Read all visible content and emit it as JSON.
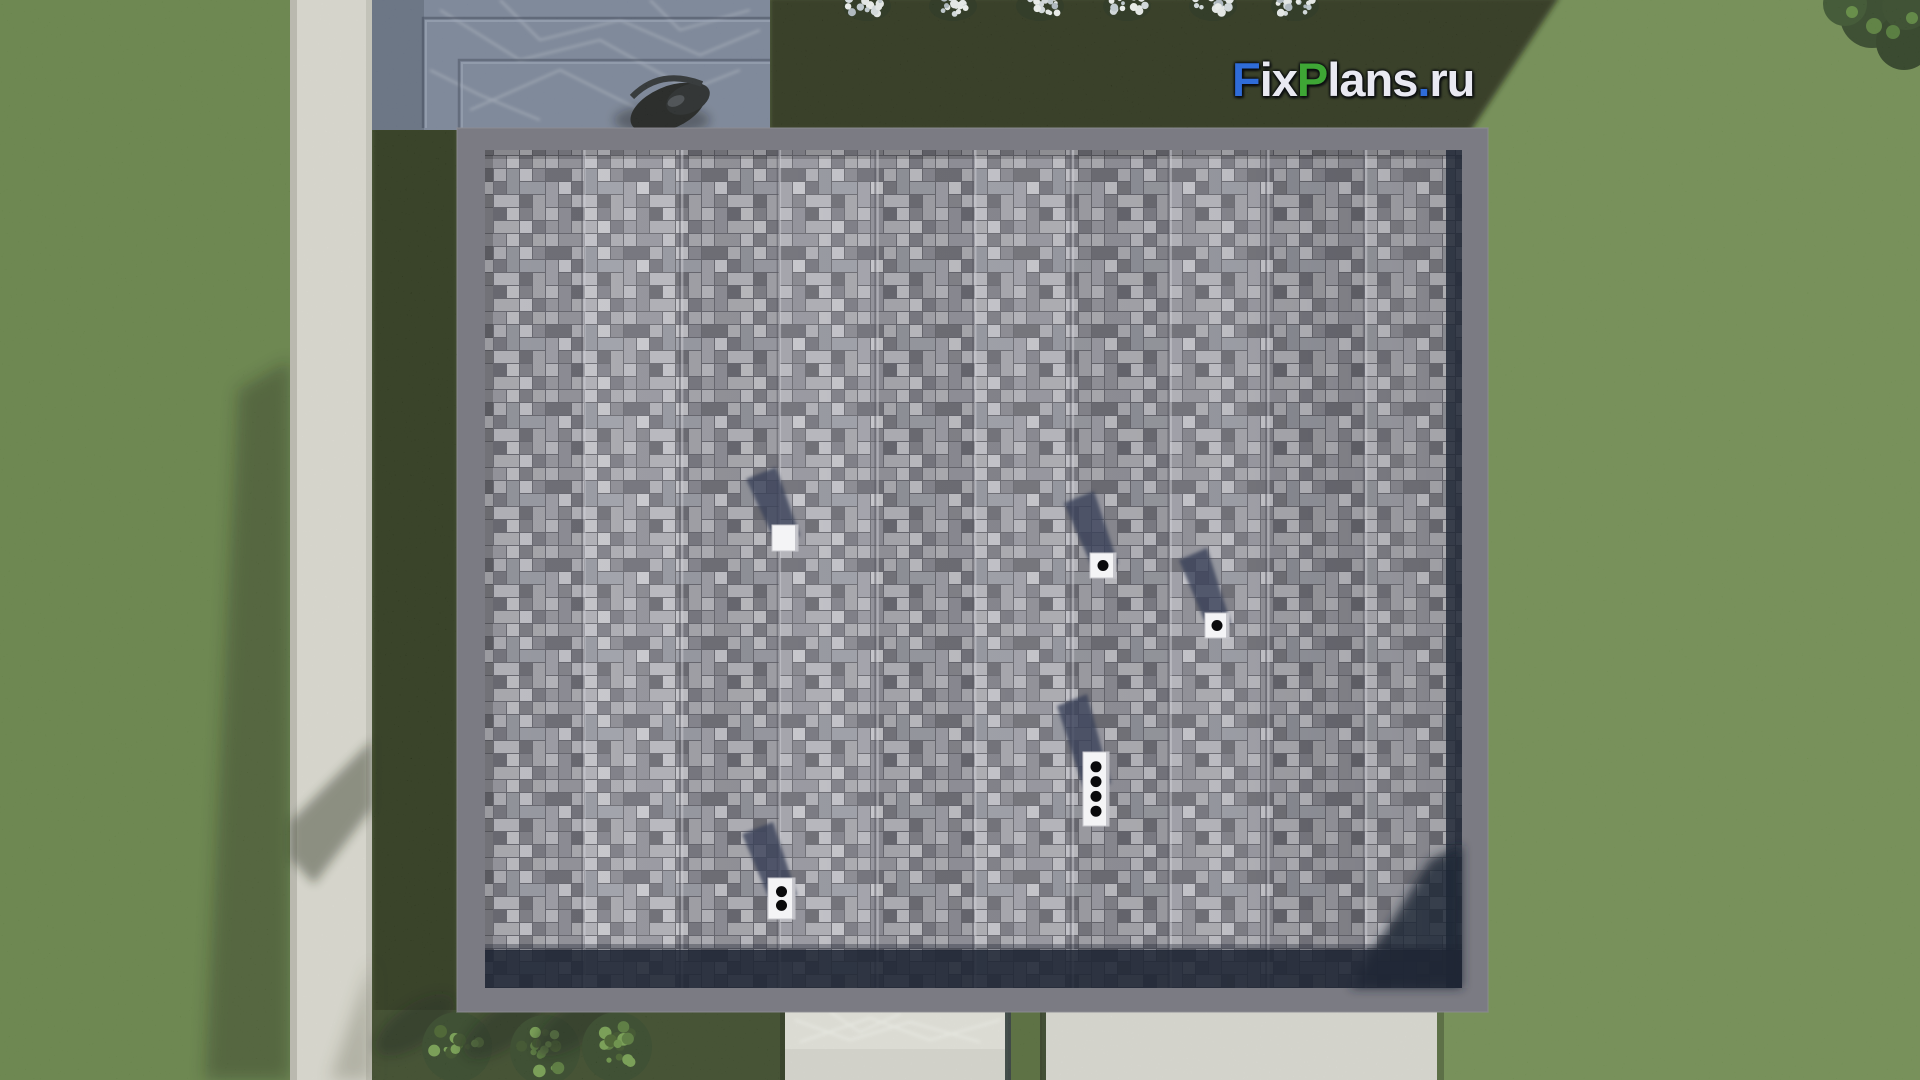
{
  "watermark": {
    "text": "FixPlans.ru",
    "parts": [
      {
        "text": "F",
        "color": "#2f6cd8"
      },
      {
        "text": "ix",
        "color": "#e9e9f2"
      },
      {
        "text": "P",
        "color": "#3ea635"
      },
      {
        "text": "lans",
        "color": "#e9e9f2"
      },
      {
        "text": ".",
        "color": "#2f6cd8"
      },
      {
        "text": "ru",
        "color": "#e9e9f2"
      }
    ]
  },
  "scene": {
    "roof_vents": [
      {
        "x": 772,
        "y": 525,
        "w": 26,
        "h": 26,
        "dots": 0,
        "shadow_len": 58
      },
      {
        "x": 1090,
        "y": 553,
        "w": 26,
        "h": 25,
        "dots": 1,
        "shadow_len": 62
      },
      {
        "x": 1205,
        "y": 613,
        "w": 24,
        "h": 25,
        "dots": 1,
        "shadow_len": 65
      },
      {
        "x": 1083,
        "y": 752,
        "w": 26,
        "h": 74,
        "dots": 4,
        "shadow_len": 58
      },
      {
        "x": 768,
        "y": 878,
        "w": 27,
        "h": 41,
        "dots": 2,
        "shadow_len": 56
      }
    ],
    "flower_clusters_x": [
      867,
      953,
      1040,
      1127,
      1213,
      1295
    ],
    "hedge_bushes": [
      {
        "x": 457,
        "y": 1047
      },
      {
        "x": 545,
        "y": 1050
      },
      {
        "x": 617,
        "y": 1047
      }
    ],
    "roof_seam_count": 9,
    "colors": {
      "grass_bright": "#69874a",
      "grass_mid_left": "#5d7b3f",
      "grass_shadow_dark": "#1c2712",
      "grass_shadow_bottom": "#2c3a1c",
      "path_concrete": "#dedbd6",
      "patio_stone": "#646e88",
      "roof_frame": "#7b7b83",
      "shingle_gap": "#6e6e76",
      "shingle_dark_strip": "#1f2634",
      "vent_white": "#f4f4f6",
      "vent_shadow": "#3a425a",
      "logo_blue": "#2f6cd8",
      "logo_green": "#3ea635",
      "logo_white": "#e9e9f2"
    }
  }
}
